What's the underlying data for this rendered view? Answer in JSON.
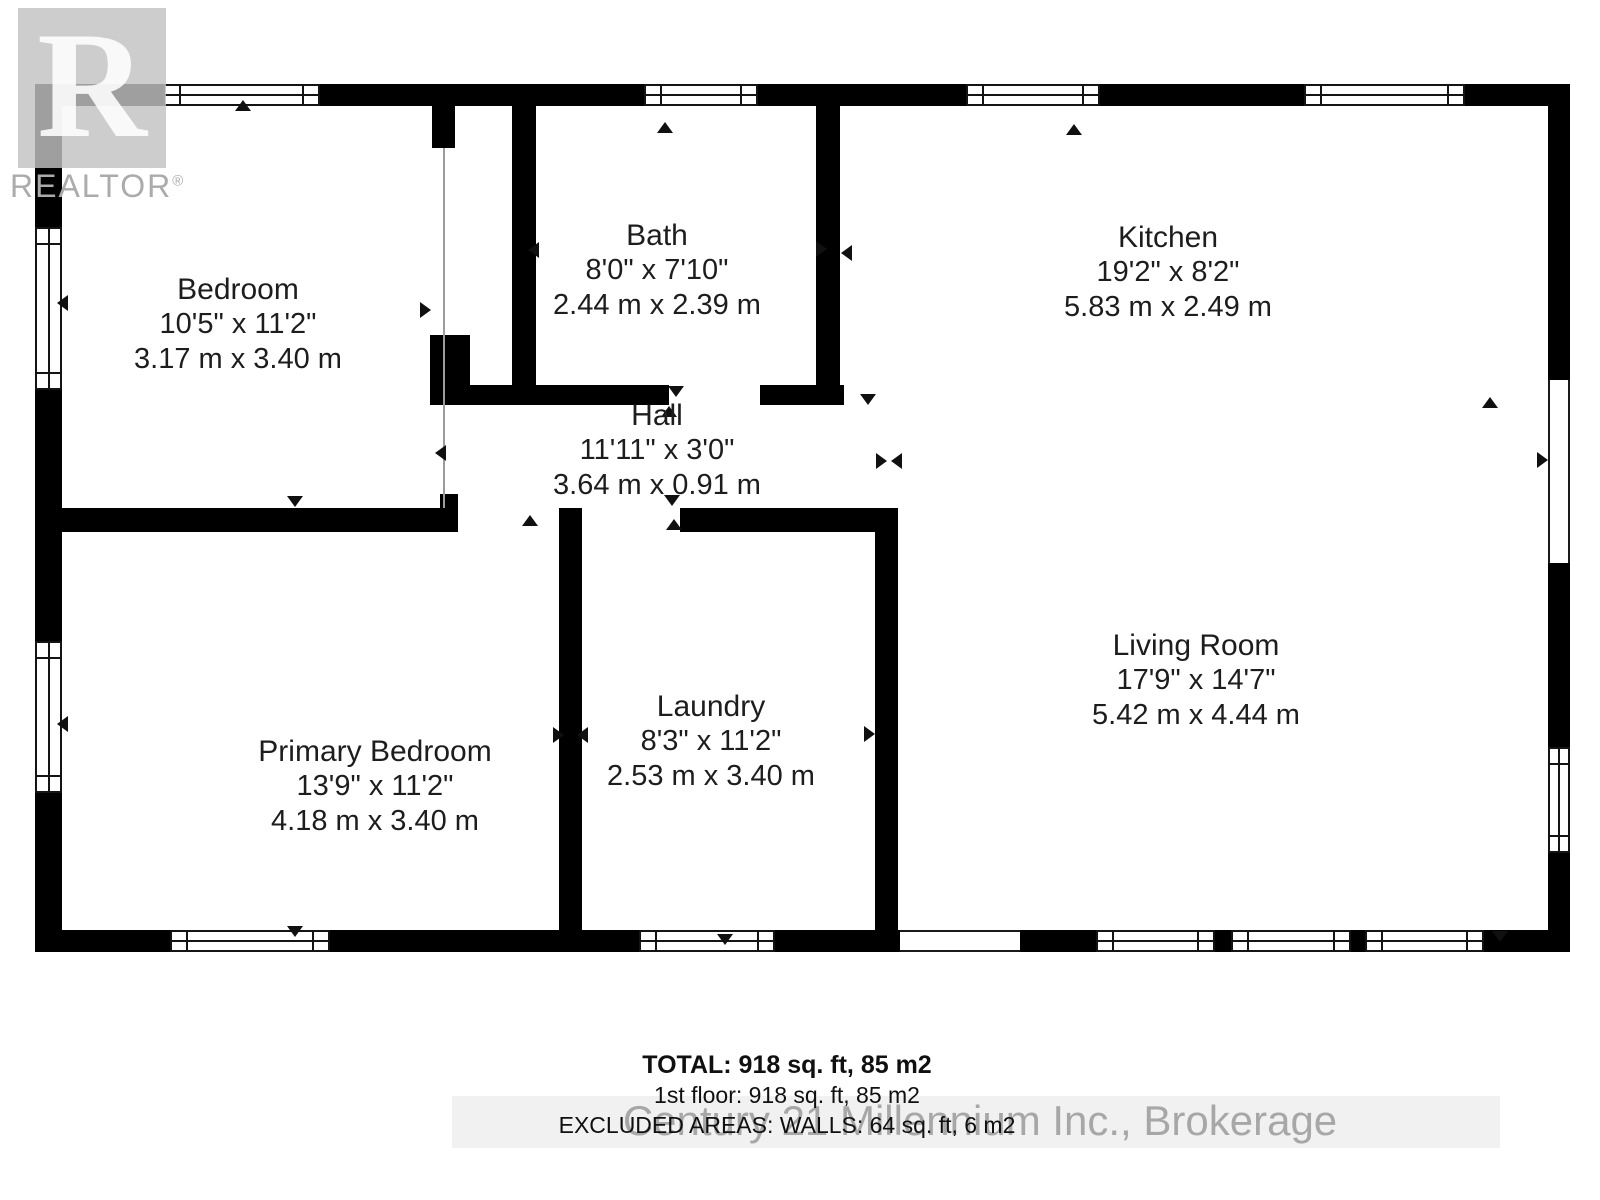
{
  "branding": {
    "logo_letter": "R",
    "logo_text": "REALTOR",
    "registered_mark": "®"
  },
  "rooms": [
    {
      "id": "bedroom",
      "name": "Bedroom",
      "imperial": "10'5\" x 11'2\"",
      "metric": "3.17 m x 3.40 m",
      "cx": 238,
      "top": 272
    },
    {
      "id": "bath",
      "name": "Bath",
      "imperial": "8'0\" x 7'10\"",
      "metric": "2.44 m x 2.39 m",
      "cx": 657,
      "top": 218
    },
    {
      "id": "kitchen",
      "name": "Kitchen",
      "imperial": "19'2\" x 8'2\"",
      "metric": "5.83 m x 2.49 m",
      "cx": 1168,
      "top": 220
    },
    {
      "id": "hall",
      "name": "Hall",
      "imperial": "11'11\" x 3'0\"",
      "metric": "3.64 m x 0.91 m",
      "cx": 657,
      "top": 398
    },
    {
      "id": "primary-bedroom",
      "name": "Primary Bedroom",
      "imperial": "13'9\" x 11'2\"",
      "metric": "4.18 m x 3.40 m",
      "cx": 375,
      "top": 734
    },
    {
      "id": "laundry",
      "name": "Laundry",
      "imperial": "8'3\" x 11'2\"",
      "metric": "2.53 m x 3.40 m",
      "cx": 711,
      "top": 689
    },
    {
      "id": "living-room",
      "name": "Living Room",
      "imperial": "17'9\" x 14'7\"",
      "metric": "5.42 m x 4.44 m",
      "cx": 1196,
      "top": 628
    }
  ],
  "footer": {
    "total": "TOTAL: 918 sq. ft, 85 m2",
    "floor": "1st floor: 918 sq. ft, 85 m2",
    "excluded": "EXCLUDED AREAS: WALLS: 64 sq. ft, 6 m2"
  },
  "watermark": "Century 21 Millennium Inc., Brokerage",
  "colors": {
    "wall": "#000000",
    "text": "#1d1d1d",
    "logo_gray": "#c2c2c2",
    "watermark_gray": "#8a8a8a"
  },
  "plan": {
    "walls": [
      [
        35,
        84,
        1535,
        22
      ],
      [
        35,
        84,
        27,
        868
      ],
      [
        1548,
        84,
        22,
        296
      ],
      [
        1548,
        563,
        22,
        184
      ],
      [
        1548,
        853,
        22,
        99
      ],
      [
        35,
        930,
        865,
        22
      ],
      [
        1020,
        930,
        550,
        22
      ],
      [
        432,
        106,
        23,
        42
      ],
      [
        430,
        335,
        40,
        70
      ],
      [
        512,
        106,
        24,
        279
      ],
      [
        816,
        106,
        24,
        299
      ],
      [
        430,
        385,
        239,
        20
      ],
      [
        760,
        385,
        84,
        20
      ],
      [
        35,
        508,
        423,
        24
      ],
      [
        440,
        494,
        18,
        14
      ],
      [
        680,
        508,
        218,
        24
      ],
      [
        559,
        508,
        23,
        444
      ],
      [
        875,
        508,
        23,
        444
      ]
    ],
    "windows_h": [
      [
        163,
        84,
        157,
        22
      ],
      [
        644,
        84,
        114,
        22
      ],
      [
        966,
        84,
        134,
        22
      ],
      [
        1304,
        84,
        161,
        22
      ],
      [
        170,
        930,
        160,
        22
      ],
      [
        639,
        930,
        136,
        22
      ],
      [
        1096,
        930,
        119,
        22
      ],
      [
        1231,
        930,
        120,
        22
      ],
      [
        1365,
        930,
        119,
        22
      ]
    ],
    "windows_v": [
      [
        35,
        227,
        27,
        163
      ],
      [
        35,
        641,
        27,
        152
      ],
      [
        1548,
        747,
        22,
        106
      ]
    ],
    "openings": [
      {
        "x": 1548,
        "y": 380,
        "w": 22,
        "h": 183,
        "dir": "v"
      },
      {
        "x": 900,
        "y": 930,
        "w": 120,
        "h": 22,
        "dir": "h"
      }
    ],
    "boundary_lines": [
      [
        443,
        148,
        2,
        360
      ]
    ],
    "door_markers": [
      [
        243,
        107,
        "up"
      ],
      [
        665,
        129,
        "up"
      ],
      [
        1074,
        131,
        "up"
      ],
      [
        1490,
        404,
        "up"
      ],
      [
        65,
        302,
        "left"
      ],
      [
        65,
        723,
        "left"
      ],
      [
        428,
        309,
        "right"
      ],
      [
        536,
        249,
        "left"
      ],
      [
        824,
        248,
        "right"
      ],
      [
        849,
        252,
        "left"
      ],
      [
        676,
        393,
        "down"
      ],
      [
        669,
        413,
        "up"
      ],
      [
        868,
        401,
        "down"
      ],
      [
        1545,
        459,
        "right"
      ],
      [
        884,
        460,
        "right"
      ],
      [
        899,
        460,
        "left"
      ],
      [
        443,
        452,
        "left"
      ],
      [
        295,
        503,
        "down"
      ],
      [
        530,
        522,
        "up"
      ],
      [
        672,
        502,
        "down"
      ],
      [
        674,
        526,
        "up"
      ],
      [
        561,
        734,
        "right"
      ],
      [
        585,
        734,
        "left"
      ],
      [
        872,
        733,
        "right"
      ],
      [
        295,
        933,
        "down"
      ],
      [
        725,
        941,
        "down"
      ],
      [
        1500,
        938,
        "down"
      ]
    ]
  }
}
